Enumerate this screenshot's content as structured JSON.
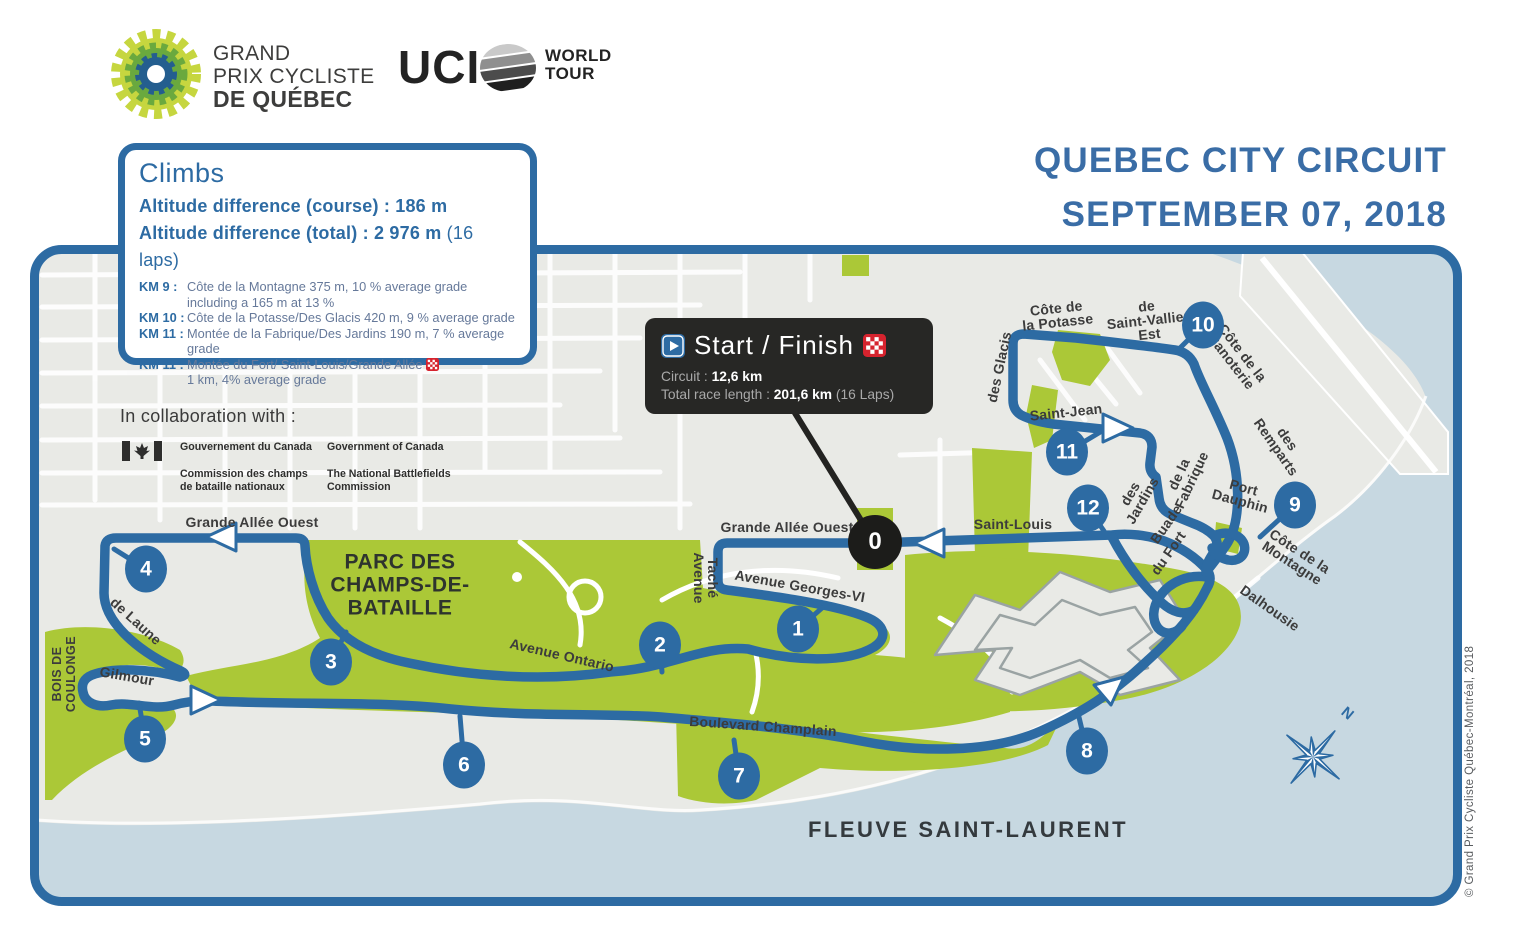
{
  "colors": {
    "accent_blue": "#2d6ba3",
    "title_blue": "#3a6da6",
    "park_green": "#abc837",
    "water_blue": "#c7d8e1",
    "map_gray": "#e9eae6",
    "dark_box": "#272725",
    "flag_red": "#d6232e"
  },
  "header": {
    "logo": {
      "icon": "gear-logo",
      "line1": "GRAND",
      "line2": "PRIX CYCLISTE",
      "line3": "DE QUÉBEC"
    },
    "uci": {
      "acronym": "UCI",
      "icon": "globe-icon",
      "world": "WORLD",
      "tour": "TOUR"
    },
    "title_line1": "QUEBEC CITY CIRCUIT",
    "title_line2": "SEPTEMBER 07, 2018"
  },
  "climbs": {
    "title": "Climbs",
    "course_label": "Altitude difference (course) :",
    "course_value": "186 m",
    "total_label": "Altitude difference (total) :",
    "total_value": "2 976 m",
    "total_suffix": "(16 laps)",
    "items": [
      {
        "km": "KM 9 :",
        "text": "Côte de la Montagne 375 m, 10 % average grade",
        "text2": "including a 165 m at 13 %"
      },
      {
        "km": "KM 10 :",
        "text": "Côte de la Potasse/Des Glacis 420 m, 9 % average grade"
      },
      {
        "km": "KM 11 :",
        "text": "Montée de la Fabrique/Des Jardins 190 m, 7 % average grade"
      },
      {
        "km": "KM 11 :",
        "text": "Montée du Fort/ Saint-Louis/Grande Allée",
        "text2": "1 km, 4% average grade"
      }
    ]
  },
  "collaboration": {
    "label": "In collaboration with :",
    "flag_icon": "canada-flag",
    "fr_line1": "Gouvernement du Canada",
    "fr_line2": "Commission des champs",
    "fr_line3": "de bataille nationaux",
    "en_line1": "Government of Canada",
    "en_line2": "The National Battlefields",
    "en_line3": "Commission"
  },
  "start_finish": {
    "title": "Start / Finish",
    "play_icon": "play-icon",
    "flag_icon": "checkered-flag-icon",
    "circuit_label": "Circuit :",
    "circuit_value": "12,6 km",
    "total_label": "Total race length :",
    "total_value": "201,6 km",
    "total_suffix": "(16 Laps)"
  },
  "map": {
    "markers": [
      "0",
      "1",
      "2",
      "3",
      "4",
      "5",
      "6",
      "7",
      "8",
      "9",
      "10",
      "11",
      "12"
    ],
    "streets": {
      "grande_allee_w": [
        "Grande Allée Ouest"
      ],
      "grande_allee_c": [
        "Grande Allée Ouest"
      ],
      "saint_louis": [
        "Saint-Louis"
      ],
      "avenue_tache": [
        "Avenue",
        "Taché"
      ],
      "georges_vi": [
        "Avenue Georges-VI"
      ],
      "ontario": [
        "Avenue Ontario"
      ],
      "champlain": [
        "Boulevard Champlain"
      ],
      "de_laune": [
        "de Laune"
      ],
      "gilmour": [
        "Gilmour"
      ],
      "des_glacis": [
        "des Glacis"
      ],
      "potasse": [
        "Côte de",
        "la Potasse"
      ],
      "saint_vallier": [
        "de",
        "Saint-Vallier",
        "Est"
      ],
      "saint_jean": [
        "Saint-Jean"
      ],
      "fabrique": [
        "de la",
        "Fabrique"
      ],
      "jardins": [
        "des",
        "Jardins"
      ],
      "buade": [
        "Buade"
      ],
      "canoterie": [
        "Côte de la",
        "Canoterie"
      ],
      "remparts": [
        "des",
        "Remparts"
      ],
      "port_dauphin": [
        "Port",
        "Dauphin"
      ],
      "du_fort": [
        "du Fort"
      ],
      "montagne": [
        "Côte de la",
        "Montagne"
      ],
      "dalhousie": [
        "Dalhousie"
      ],
      "parc": [
        "PARC DES",
        "CHAMPS-DE-",
        "BATAILLE"
      ],
      "bois": [
        "BOIS DE",
        "COULONGE"
      ],
      "fleuve": [
        "FLEUVE SAINT-LAURENT"
      ]
    },
    "compass": "N"
  },
  "copyright": "© Grand Prix Cycliste Québec-Montréal, 2018"
}
